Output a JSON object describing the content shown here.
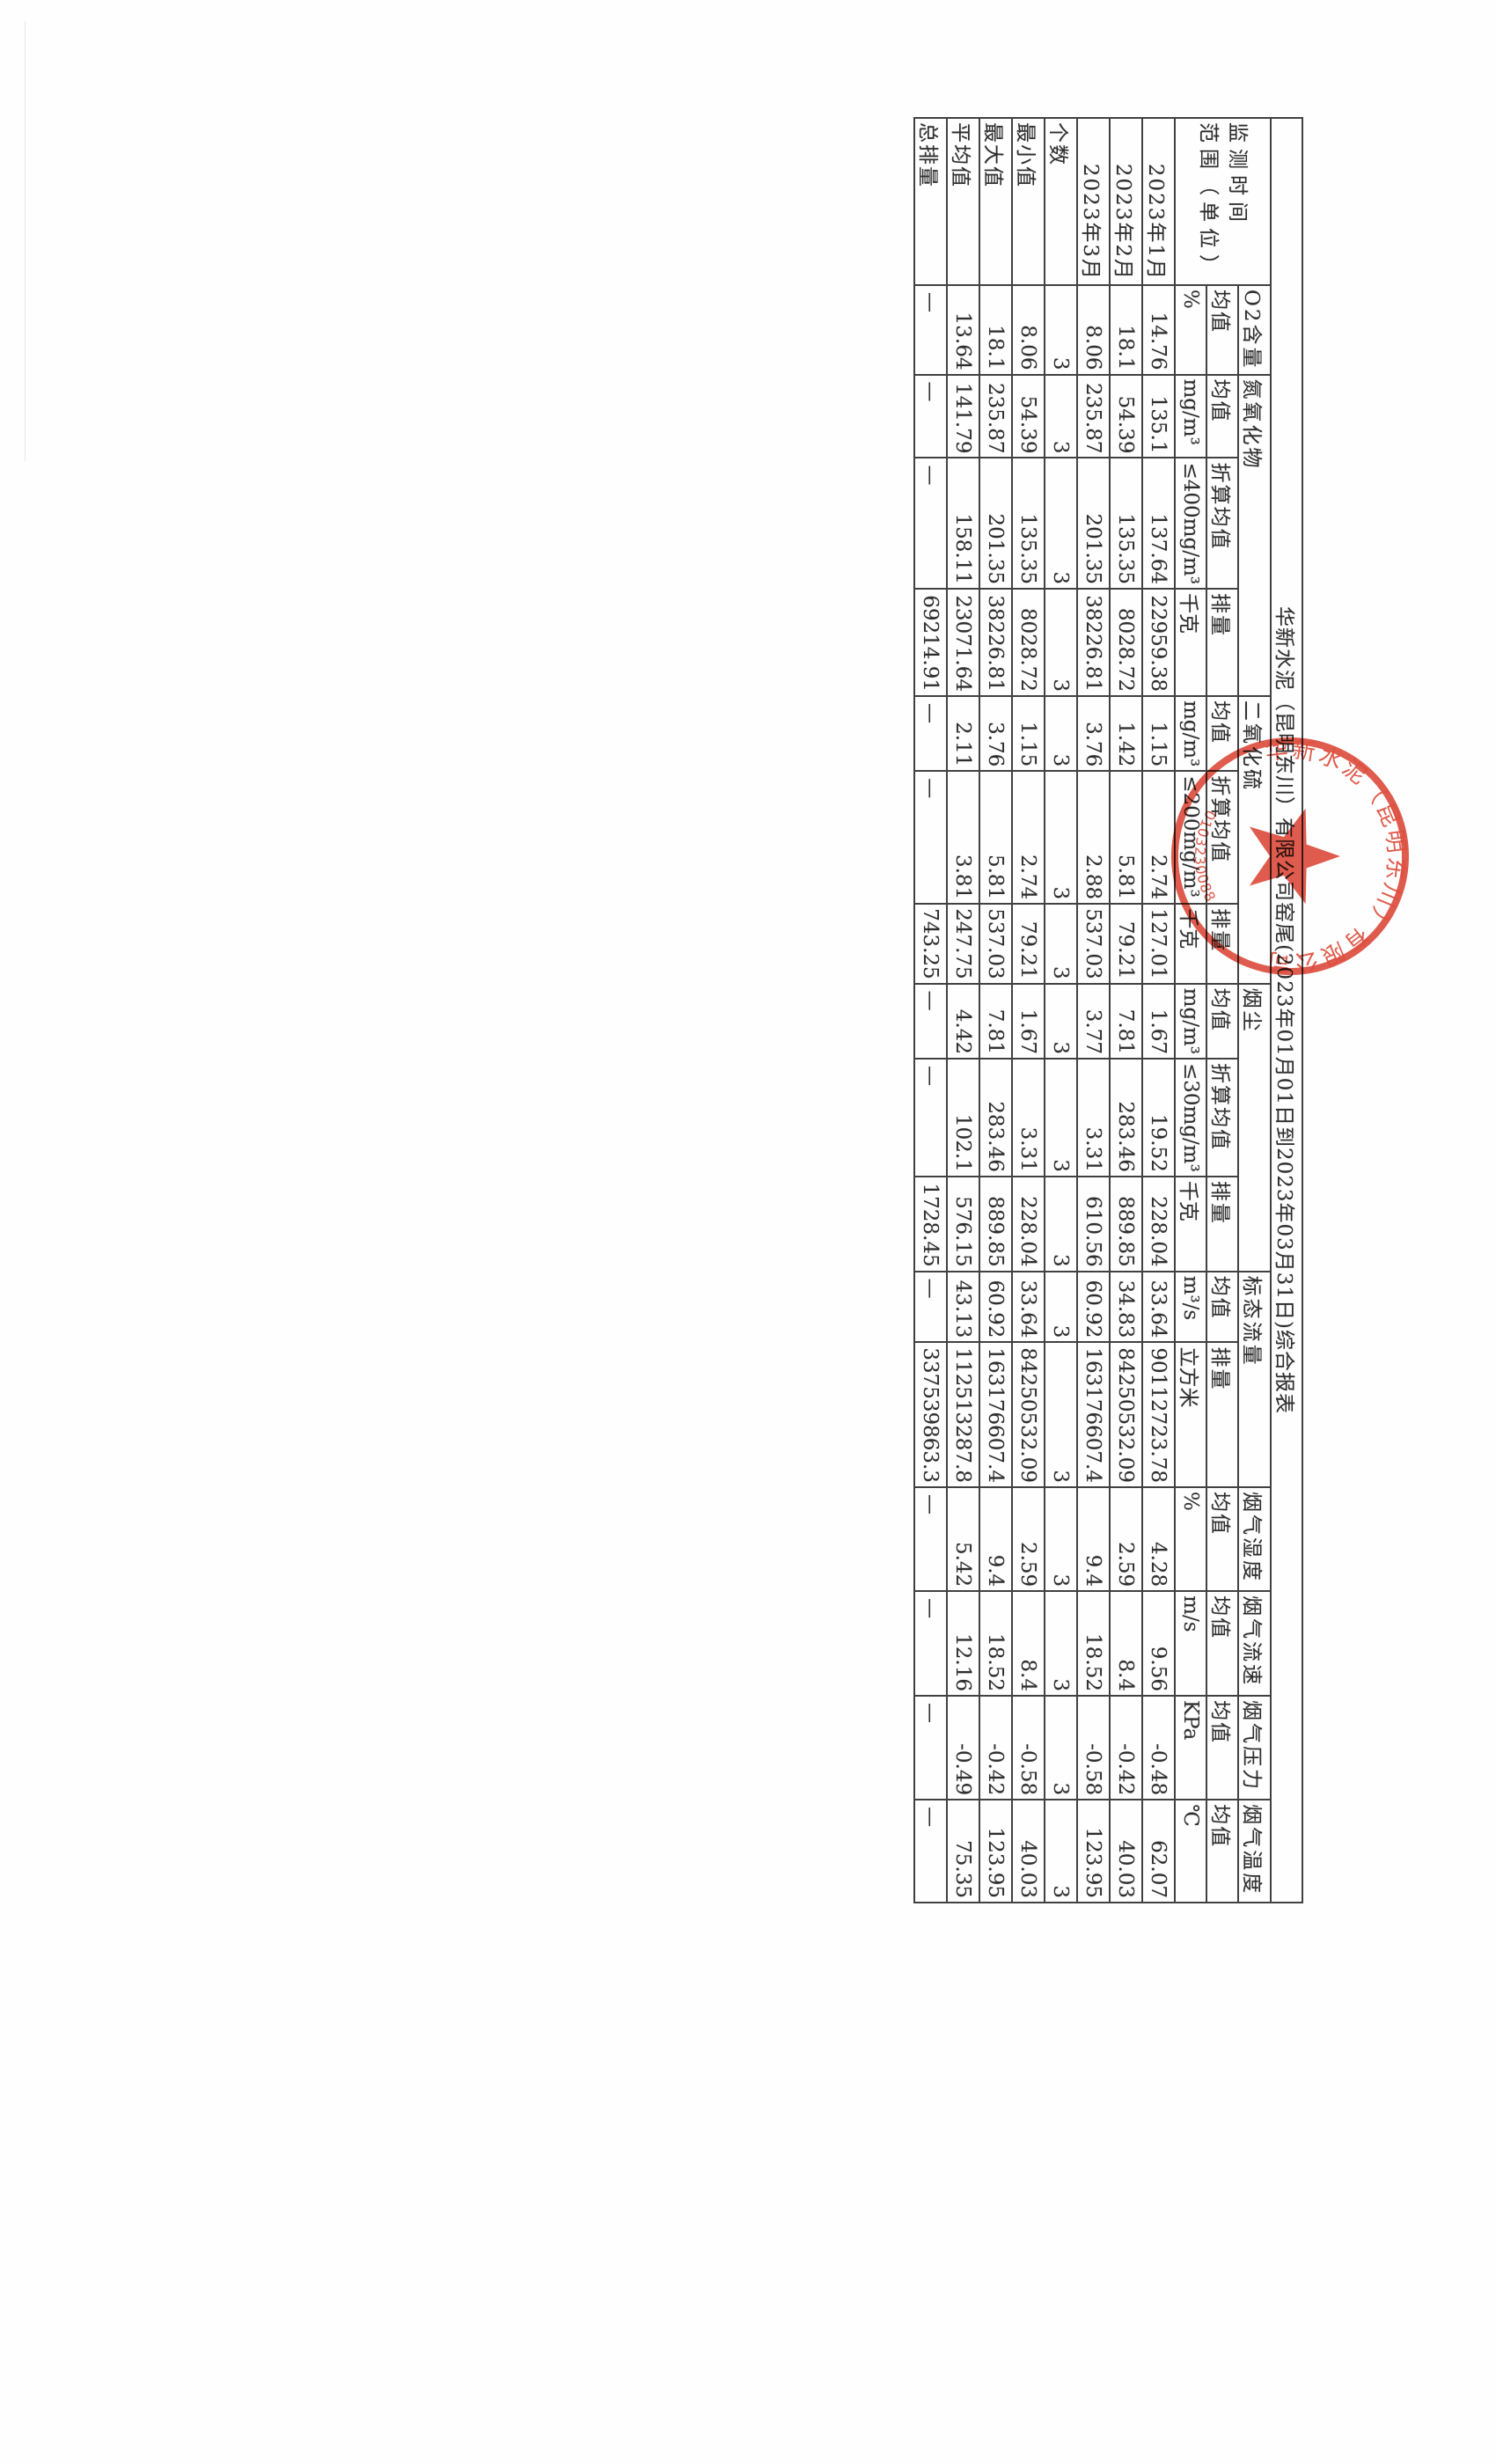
{
  "document": {
    "title": "华新水泥（昆明东川）有限公司窑尾(2023年01月01日到2023年03月31日)综合报表",
    "corner_header_line1": "监测时间",
    "corner_header_line2": "范围（单位）",
    "row_labels": [
      "2023年1月",
      "2023年2月",
      "2023年3月",
      "个数",
      "最小值",
      "最大值",
      "平均值",
      "总排量"
    ],
    "columns": [
      {
        "group": "O2含量",
        "label": "均值",
        "unit": "%",
        "values": [
          "14.76",
          "18.1",
          "8.06",
          "3",
          "8.06",
          "18.1",
          "13.64",
          "—"
        ]
      },
      {
        "group": "氮氧化物",
        "label": "均值",
        "unit": "mg/m³",
        "values": [
          "135.1",
          "54.39",
          "235.87",
          "3",
          "54.39",
          "235.87",
          "141.79",
          "—"
        ]
      },
      {
        "group": "氮氧化物",
        "label": "折算均值",
        "unit": "≤400mg/m³",
        "values": [
          "137.64",
          "135.35",
          "201.35",
          "3",
          "135.35",
          "201.35",
          "158.11",
          "—"
        ]
      },
      {
        "group": "氮氧化物",
        "label": "排量",
        "unit": "千克",
        "values": [
          "22959.38",
          "8028.72",
          "38226.81",
          "3",
          "8028.72",
          "38226.81",
          "23071.64",
          "69214.91"
        ]
      },
      {
        "group": "二氧化硫",
        "label": "均值",
        "unit": "mg/m³",
        "values": [
          "1.15",
          "1.42",
          "3.76",
          "3",
          "1.15",
          "3.76",
          "2.11",
          "—"
        ]
      },
      {
        "group": "二氧化硫",
        "label": "折算均值",
        "unit": "≤200mg/m³",
        "values": [
          "2.74",
          "5.81",
          "2.88",
          "3",
          "2.74",
          "5.81",
          "3.81",
          "—"
        ]
      },
      {
        "group": "二氧化硫",
        "label": "排量",
        "unit": "千克",
        "values": [
          "127.01",
          "79.21",
          "537.03",
          "3",
          "79.21",
          "537.03",
          "247.75",
          "743.25"
        ]
      },
      {
        "group": "烟尘",
        "label": "均值",
        "unit": "mg/m³",
        "values": [
          "1.67",
          "7.81",
          "3.77",
          "3",
          "1.67",
          "7.81",
          "4.42",
          "—"
        ]
      },
      {
        "group": "烟尘",
        "label": "折算均值",
        "unit": "≤30mg/m³",
        "values": [
          "19.52",
          "283.46",
          "3.31",
          "3",
          "3.31",
          "283.46",
          "102.1",
          "—"
        ]
      },
      {
        "group": "烟尘",
        "label": "排量",
        "unit": "千克",
        "values": [
          "228.04",
          "889.85",
          "610.56",
          "3",
          "228.04",
          "889.85",
          "576.15",
          "1728.45"
        ]
      },
      {
        "group": "标态流量",
        "label": "均值",
        "unit": "m³/s",
        "values": [
          "33.64",
          "34.83",
          "60.92",
          "3",
          "33.64",
          "60.92",
          "43.13",
          "—"
        ]
      },
      {
        "group": "标态流量",
        "label": "排量",
        "unit": "立方米",
        "values": [
          "90112723.78",
          "84250532.09",
          "163176607.4",
          "3",
          "84250532.09",
          "163176607.4",
          "112513287.8",
          "337539863.3"
        ]
      },
      {
        "group": "烟气湿度",
        "label": "均值",
        "unit": "%",
        "values": [
          "4.28",
          "2.59",
          "9.4",
          "3",
          "2.59",
          "9.4",
          "5.42",
          "—"
        ]
      },
      {
        "group": "烟气流速",
        "label": "均值",
        "unit": "m/s",
        "values": [
          "9.56",
          "8.4",
          "18.52",
          "3",
          "8.4",
          "18.52",
          "12.16",
          "—"
        ]
      },
      {
        "group": "烟气压力",
        "label": "均值",
        "unit": "KPa",
        "values": [
          "-0.48",
          "-0.42",
          "-0.58",
          "3",
          "-0.58",
          "-0.42",
          "-0.49",
          "—"
        ]
      },
      {
        "group": "烟气温度",
        "label": "均值",
        "unit": "℃",
        "values": [
          "62.07",
          "40.03",
          "123.95",
          "3",
          "40.03",
          "123.95",
          "75.35",
          "—"
        ]
      }
    ],
    "empty_cell_text": "—"
  },
  "seal": {
    "company_name": "华新水泥（昆明东川）有限公司",
    "number": "301032300884",
    "color": "#d93a28"
  },
  "colors": {
    "paper": "#fefefe",
    "ink": "#2e2e2e",
    "grid": "#414141",
    "seal_red": "#d93a28"
  }
}
